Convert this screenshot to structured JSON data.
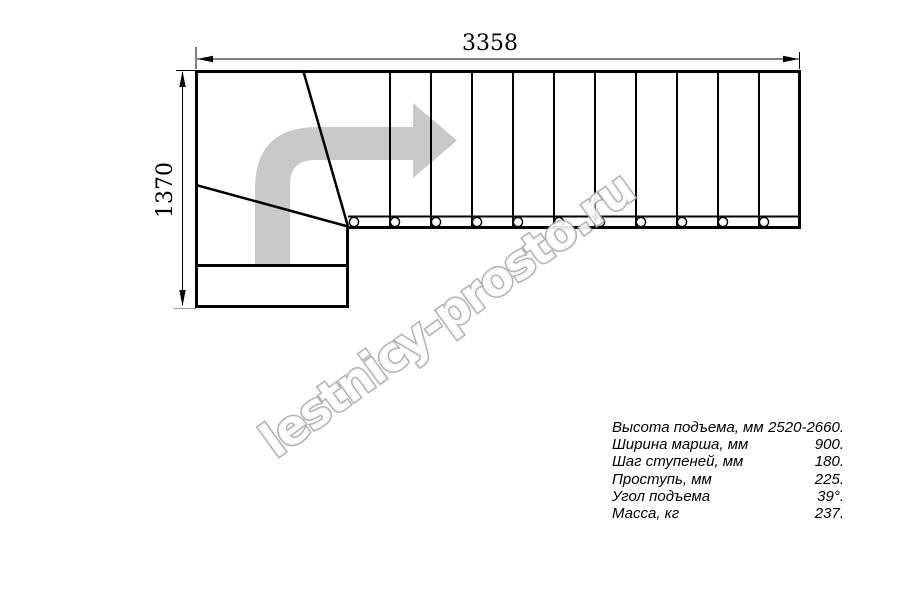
{
  "dimensions": {
    "width_label": "3358",
    "height_label": "1370"
  },
  "specs": {
    "rows": [
      {
        "label": "Высота подъема, мм",
        "value": "2520-2660."
      },
      {
        "label": "Ширина марша, мм",
        "value": "900."
      },
      {
        "label": "Шаг ступеней, мм",
        "value": "180."
      },
      {
        "label": "Проступь, мм",
        "value": "225."
      },
      {
        "label": "Угол подъема",
        "value": "39°."
      },
      {
        "label": "Масса, кг",
        "value": "237."
      }
    ]
  },
  "watermark": {
    "text": "lestnicy-prosto.ru"
  },
  "colors": {
    "line": "#000000",
    "arrow_fill": "#c9c9c9",
    "dim_line": "#000000",
    "extension_gray": "#9a9a9a"
  }
}
